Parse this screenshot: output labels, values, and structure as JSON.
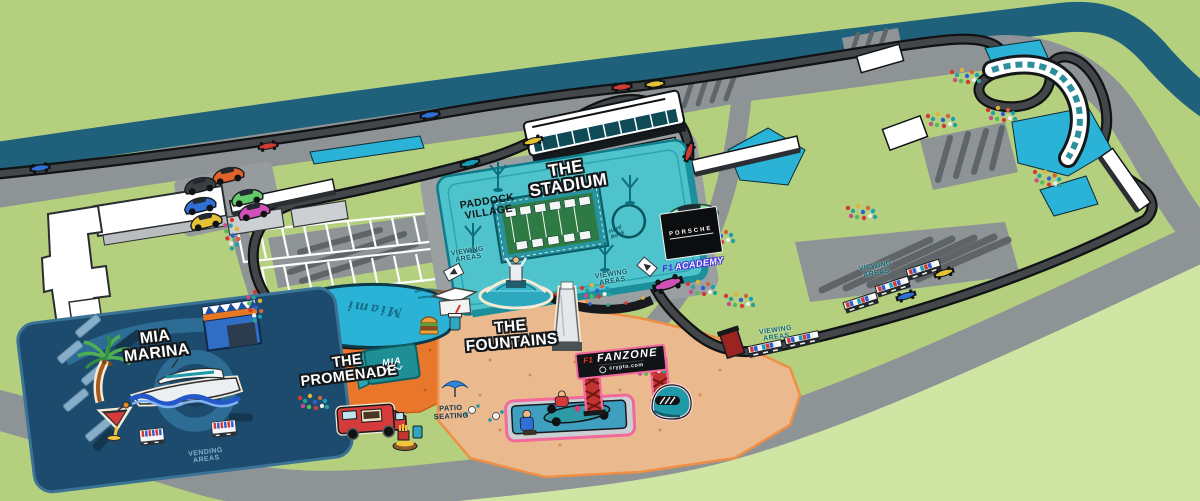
{
  "map": {
    "stadium": {
      "name": "THE\nSTADIUM"
    },
    "paddock": {
      "name": "PADDOCK\nVILLAGE"
    },
    "marina": {
      "name": "MIA\nMARINA"
    },
    "promenade": {
      "name": "THE\nPROMENADE"
    },
    "fountains": {
      "name": "THE\nFOUNTAINS"
    },
    "fanzone": {
      "f1_mark": "F1",
      "name": "FANZONE",
      "sponsor": "crypto.com"
    },
    "badges": {
      "porsche": "PORSCHE",
      "f1_academy_mark": "F1",
      "f1_academy": "ACADEMY",
      "hard_rock": "Hard\nRock",
      "mia_structure": "MIA",
      "miami_script": "Miami"
    },
    "small_labels": {
      "viewing": "VIEWING\nAREAS",
      "vending": "VENDING\nAREAS",
      "patio": "PATIO\nSEATING"
    },
    "colors": {
      "grass": "#b4cf7e",
      "grass_light": "#cfe5a3",
      "canal": "#1f607b",
      "road": "#8e9396",
      "track": "#43474a",
      "runoff": "#2ab3d7",
      "stadium_teal": "#4fc3cb",
      "stadium_dark": "#1b8f9c",
      "marina_navy": "#1d4b6d",
      "promenade_orange": "#e8772b",
      "fanzone_floor": "#eab98e",
      "outline_pink": "#f2699c",
      "fanzone_red": "#c2342f"
    }
  }
}
